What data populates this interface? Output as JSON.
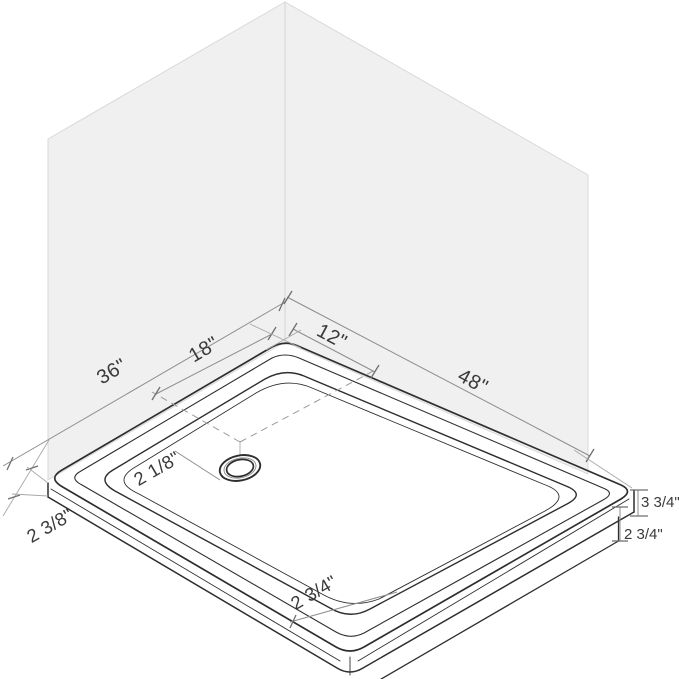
{
  "figure": {
    "description": "Isometric dimension diagram of a rectangular shower base installed against two corner walls, with an offset round drain",
    "labels": {
      "back_left_edge": "36\"",
      "drain_from_corner_left": "18\"",
      "drain_from_corner_right": "12\"",
      "back_right_edge": "48\"",
      "rim_width": "2 1/8\"",
      "left_corner_height": "2 3/8\"",
      "front_edge_height": "2 3/4\"",
      "right_corner_total_height": "3 3/4\"",
      "right_corner_flange_height": "2 3/4\""
    },
    "colors": {
      "background": "#ffffff",
      "wall_fill": "#f0f0f0",
      "wall_edge": "#d9d9d9",
      "tray_line": "#2e2e2e",
      "dimension_line": "#8d8d8d",
      "label_text": "#3a3a3a"
    }
  }
}
